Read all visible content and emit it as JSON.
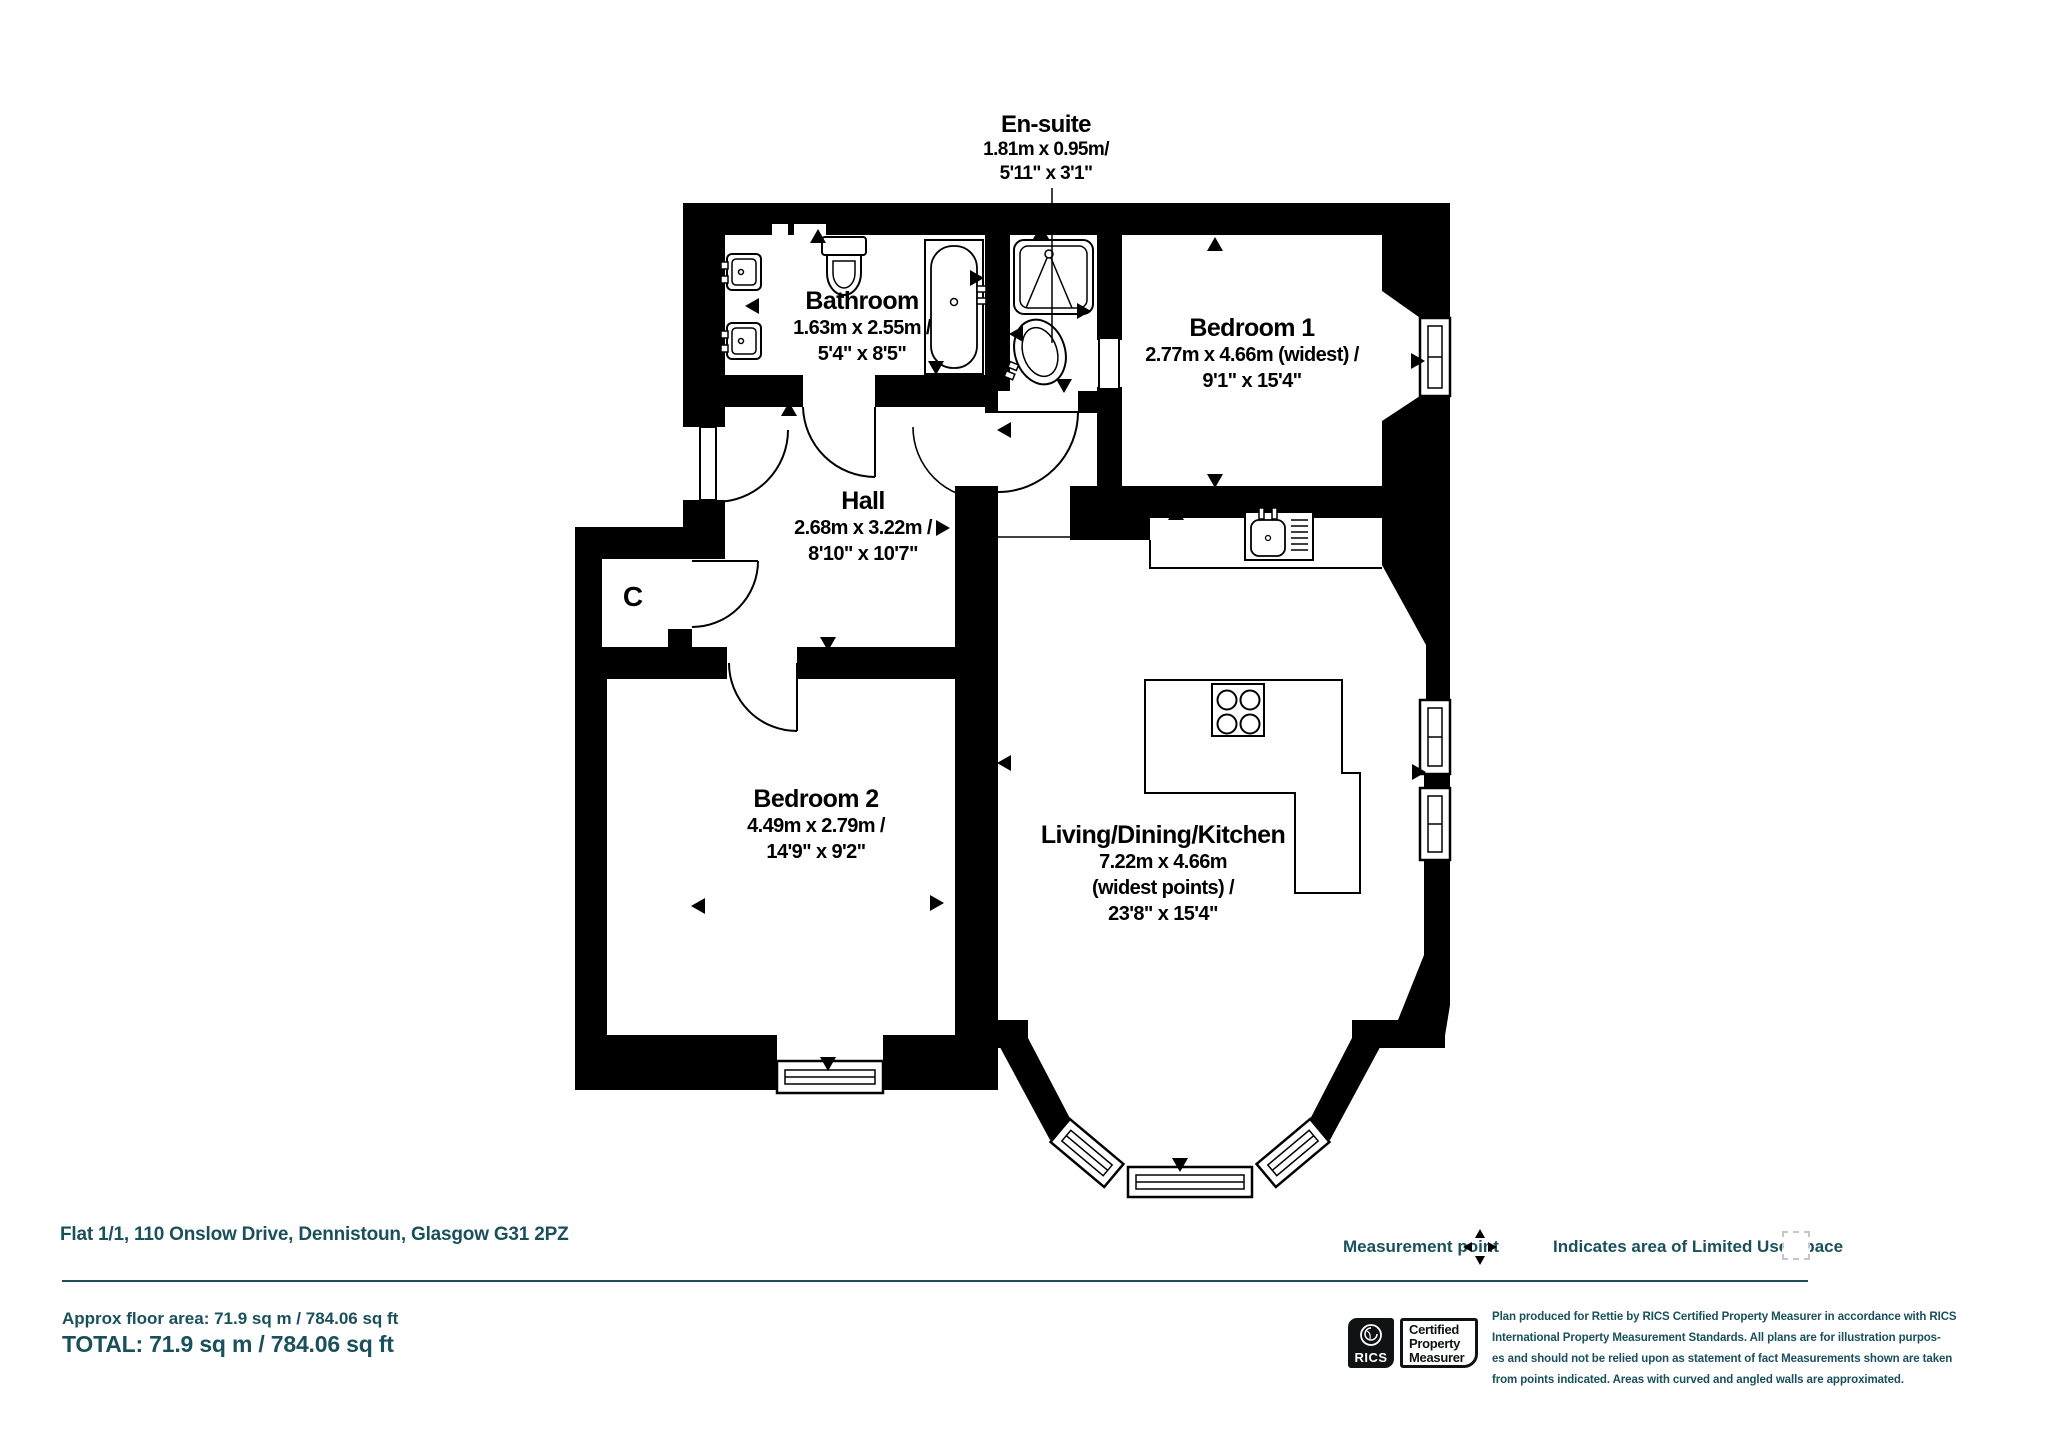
{
  "colors": {
    "wall": "#000000",
    "accent_teal": "#19505c",
    "background": "#ffffff"
  },
  "plan": {
    "rooms": [
      {
        "id": "ensuite",
        "title": "En-suite",
        "dims": [
          "1.81m x 0.95m/",
          "5'11\" x 3'1\""
        ]
      },
      {
        "id": "bathroom",
        "title": "Bathroom",
        "dims": [
          "1.63m x 2.55m /",
          "5'4\" x 8'5\""
        ]
      },
      {
        "id": "bedroom1",
        "title": "Bedroom 1",
        "dims": [
          "2.77m x 4.66m (widest) /",
          "9'1\" x 15'4\""
        ]
      },
      {
        "id": "hall",
        "title": "Hall",
        "dims": [
          "2.68m x 3.22m /",
          "8'10\" x 10'7\""
        ]
      },
      {
        "id": "closet",
        "title": "C",
        "dims": []
      },
      {
        "id": "bedroom2",
        "title": "Bedroom 2",
        "dims": [
          "4.49m x 2.79m /",
          "14'9\" x 9'2\""
        ]
      },
      {
        "id": "living",
        "title": "Living/Dining/Kitchen",
        "dims": [
          "7.22m x 4.66m",
          "(widest points) /",
          "23'8\" x 15'4\""
        ]
      }
    ],
    "icons": {
      "measurement_point_icon": "four-way-arrows",
      "limited_use_swatch": "dashed-square",
      "fixtures": [
        "bathtub-icon",
        "toilet-icon",
        "basin-icon",
        "shower-icon",
        "kitchen-sink-icon",
        "hob-icon"
      ]
    }
  },
  "footer": {
    "address": "Flat 1/1, 110 Onslow Drive, Dennistoun, Glasgow G31 2PZ",
    "measurement_point_label": "Measurement point",
    "limited_use_label": "Indicates area of  Limited Use Space",
    "approx_area": "Approx floor area: 71.9 sq m / 784.06 sq ft",
    "total": "TOTAL: 71.9 sq m / 784.06 sq ft",
    "rics_label": "RICS",
    "cert_lines": [
      "Certified",
      "Property",
      "Measurer"
    ],
    "disclaimer_lines": [
      "Plan produced for Rettie by RICS Certified Property Measurer in accordance with RICS",
      "International Property  Measurement Standards.  All plans are for illustration purpos-",
      "es and should not be relied upon as statement of fact Measurements shown are taken",
      "from points indicated. Areas with curved and angled walls are approximated."
    ]
  }
}
